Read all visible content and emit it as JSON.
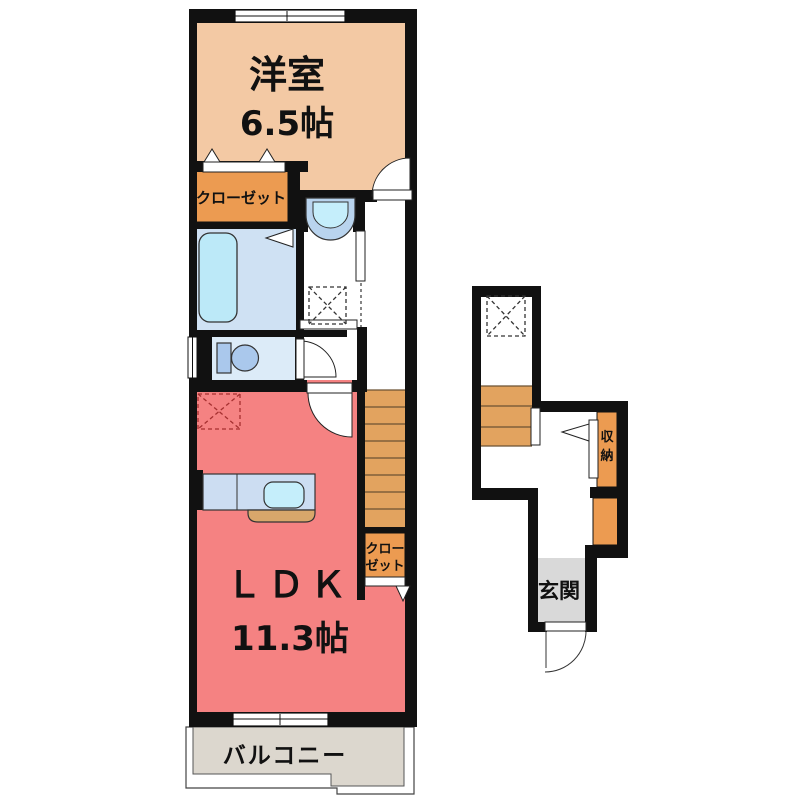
{
  "plan_title": "2F apartment floor plan",
  "rooms": {
    "western_room": {
      "label": "洋室",
      "area": "6.5帖"
    },
    "closet_top": {
      "label": "クローゼット"
    },
    "ldk": {
      "label": "ＬＤＫ",
      "area": "11.3帖"
    },
    "closet_side": {
      "lines": [
        "クロー",
        "ゼット"
      ]
    },
    "balcony": {
      "label": "バルコニー"
    },
    "storage": {
      "chars": [
        "収",
        "納"
      ]
    },
    "entrance": {
      "label": "玄関"
    }
  },
  "colors": {
    "wall": "#111111",
    "western_room": "#f3c9a4",
    "closet_orange": "#ec9b51",
    "stairs_orange": "#e2a35f",
    "ldk_salmon": "#f58282",
    "bathroom_blue": "#cfe1f3",
    "bathtub_blue": "#bce9f8",
    "toilet_room_blue": "#dcebf8",
    "fixture_blue": "#aac8ec",
    "basin_blue": "#b9d4ee",
    "counter_blue": "#ccddf2",
    "sink_blue": "#c5eefb",
    "counter_front_tan": "#d8a76b",
    "entrance_gray": "#d9d9d9",
    "balcony_gray": "#dcd7ce"
  }
}
